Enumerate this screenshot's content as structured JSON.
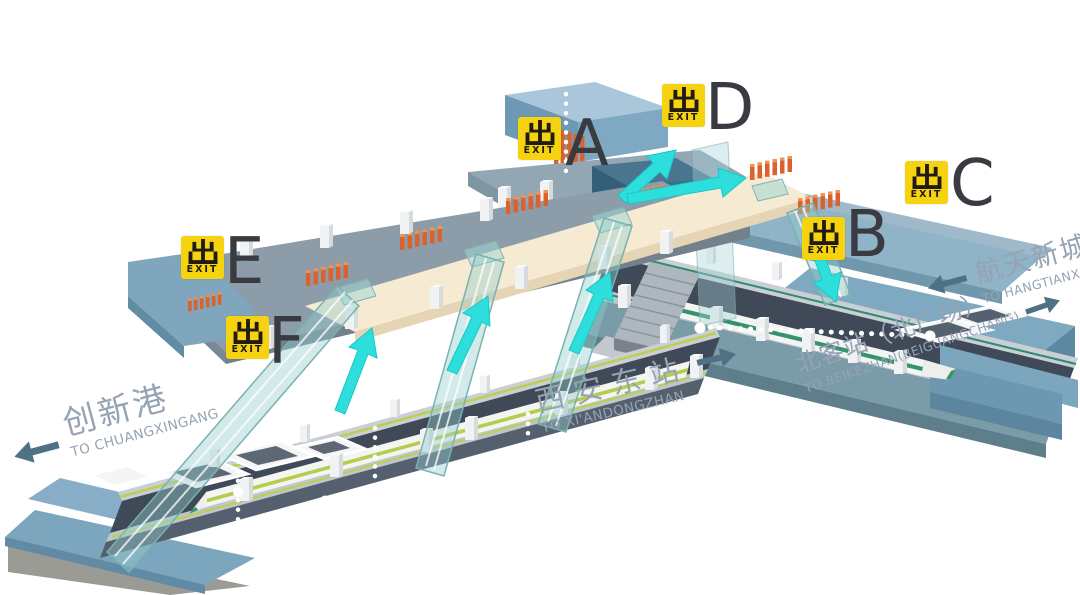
{
  "exit_sign": {
    "glyph": "出",
    "label": "EXIT"
  },
  "exits": [
    {
      "letter": "A"
    },
    {
      "letter": "B"
    },
    {
      "letter": "C"
    },
    {
      "letter": "D"
    },
    {
      "letter": "E"
    },
    {
      "letter": "F"
    }
  ],
  "destinations": {
    "chuangxingang": {
      "zh": "创新港",
      "en": "TO CHUANGXINGANG",
      "direction": "left"
    },
    "xiandongzhan": {
      "zh": "西安东站",
      "en": "TO XI'ANDONGZHAN",
      "direction": "right"
    },
    "beikezhan": {
      "zh": "北客站（北广场）",
      "en": "TO BEIKEZHAN(BEIGUANGCHANG)",
      "direction": "right"
    },
    "hangtianxincheng": {
      "zh": "航天新城",
      "en": "TO HANGTIANXINCHENG",
      "direction": "left"
    }
  },
  "colors": {
    "exit_yellow": "#F5D311",
    "flow_arrow_cyan": "#2EDEDC",
    "label_text": "#96A3B3",
    "label_arrow": "#4E7184",
    "letter_dark": "#3A3A41",
    "concourse_cream": "#F6EBD2",
    "track_slate": "#3F4957",
    "gate_orange": "#D9622E"
  }
}
